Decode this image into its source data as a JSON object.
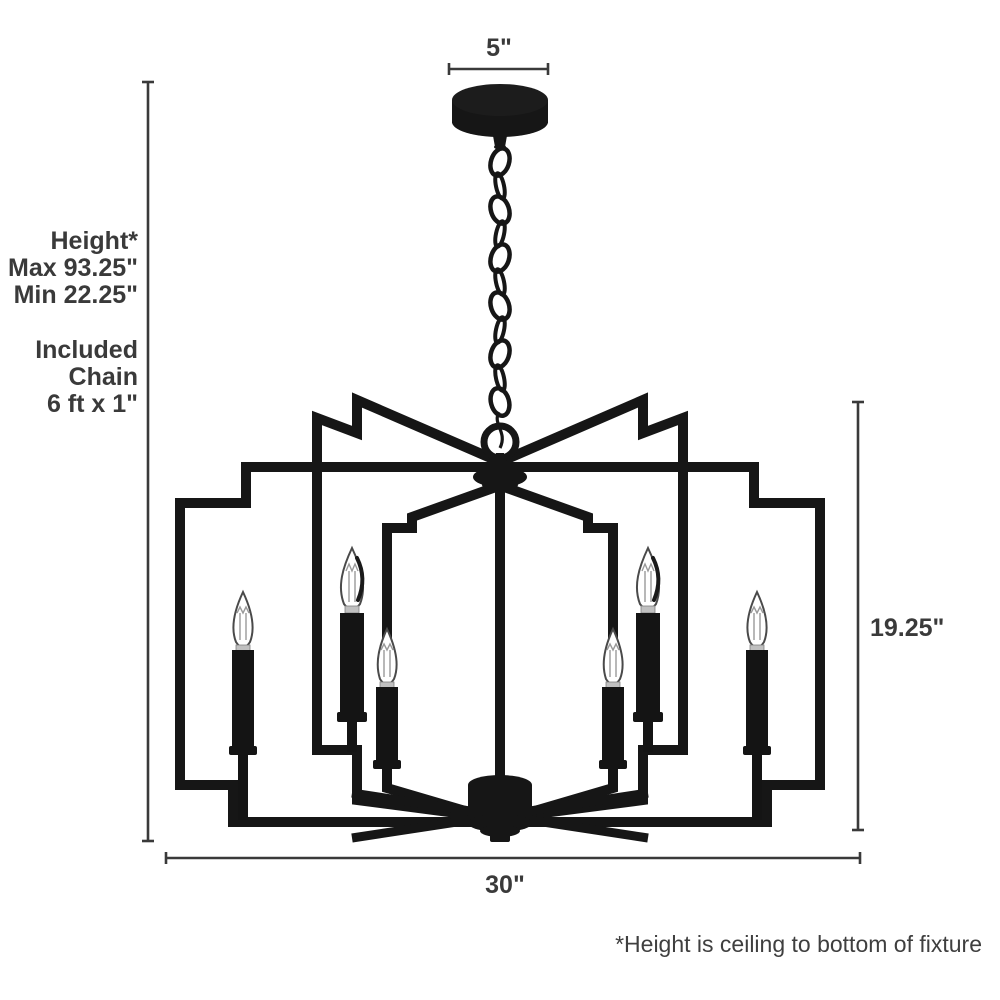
{
  "diagram": {
    "product": {
      "kind": "chandelier",
      "light_count": 6,
      "finish": "matte black"
    },
    "labels": {
      "canopy_width": "5\"",
      "height_lines": [
        "Height*",
        "Max 93.25\"",
        "Min 22.25\""
      ],
      "chain_lines": [
        "Included",
        "Chain",
        "6 ft x 1\""
      ],
      "fixture_height": "19.25\"",
      "fixture_width": "30\"",
      "footnote": "*Height is ceiling to bottom of fixture"
    },
    "colors": {
      "background": "#ffffff",
      "fixture": "#161616",
      "dimension_lines": "#3a3a3a",
      "label_text": "#3a3a3a"
    }
  }
}
